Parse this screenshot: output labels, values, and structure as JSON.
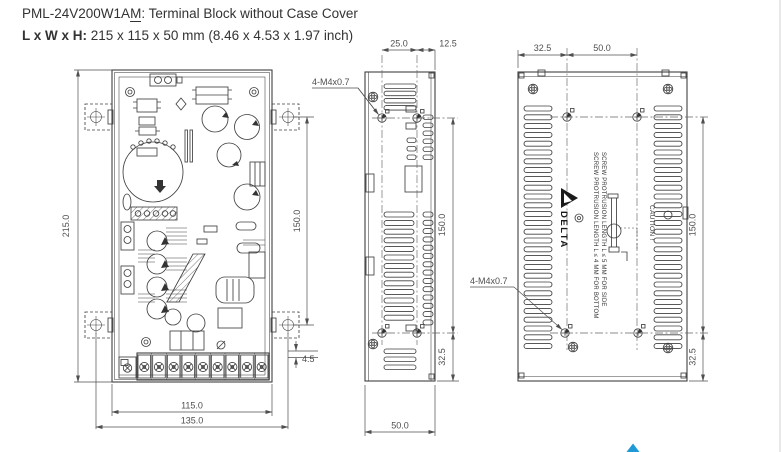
{
  "header": {
    "model_prefix": "PML-24V200W1A",
    "model_underlined": "M",
    "model_suffix": ": Terminal Block without Case Cover",
    "size_label": "L x W x H:",
    "size_value": " 215 x 115 x 50 mm (8.46 x 4.53 x 1.97 inch)"
  },
  "front_view": {
    "dim_height": "215.0",
    "dim_mount_span": "150.0",
    "dim_tab_offset": "4.5",
    "dim_body_width": "115.0",
    "dim_mount_width": "135.0"
  },
  "side_view": {
    "screw_spec": "4-M4x0.7",
    "dim_hole_span": "25.0",
    "dim_hole_to_edge": "12.5",
    "dim_mount_span": "150.0",
    "dim_bottom_offset": "32.5",
    "dim_depth": "50.0"
  },
  "back_view": {
    "screw_spec": "4-M4x0.7",
    "dim_edge_to_hole": "32.5",
    "dim_hole_span": "50.0",
    "dim_mount_span": "150.0",
    "dim_bottom_offset": "32.5",
    "note_bottom": "SCREW PROTRUSION LENGTH  L ≤ 4 MM FOR BOTTOM",
    "note_side": "SCREW PROTRUSION LENGTH  L ≤ 5 MM FOR SIDE",
    "caution": "CAUTION !",
    "brand": "DELTA"
  },
  "colors": {
    "line": "#404040",
    "dimension": "#4f4f4f",
    "accent": "#1f9ad6"
  }
}
